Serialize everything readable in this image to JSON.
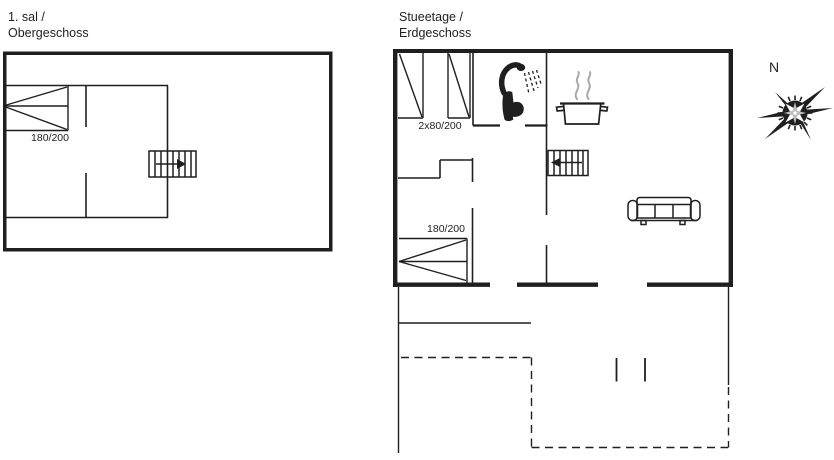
{
  "colors": {
    "bg": "#ffffff",
    "line": "#1f1f1f",
    "steam": "#a9a9a9"
  },
  "plans": {
    "upper": {
      "title_line1": "1. sal /",
      "title_line2": "Obergeschoss",
      "labels": {
        "window": "180/200"
      }
    },
    "ground": {
      "title_line1": "Stueetage /",
      "title_line2": "Erdgeschoss",
      "labels": {
        "windows_top": "2x80/200",
        "window_bottom": "180/200"
      }
    }
  },
  "compass": {
    "label": "N"
  },
  "icons": {
    "shower": "shower-icon",
    "toilet": "toilet-icon",
    "cooking_pot": "cooking-pot-icon",
    "sofa": "sofa-icon",
    "stairs_upper": "stairs-arrow-right-icon",
    "stairs_ground": "stairs-arrow-left-icon",
    "compass": "compass-rose-icon",
    "windows": "window-symbol",
    "terrace": "terrace-dashed-outline"
  }
}
